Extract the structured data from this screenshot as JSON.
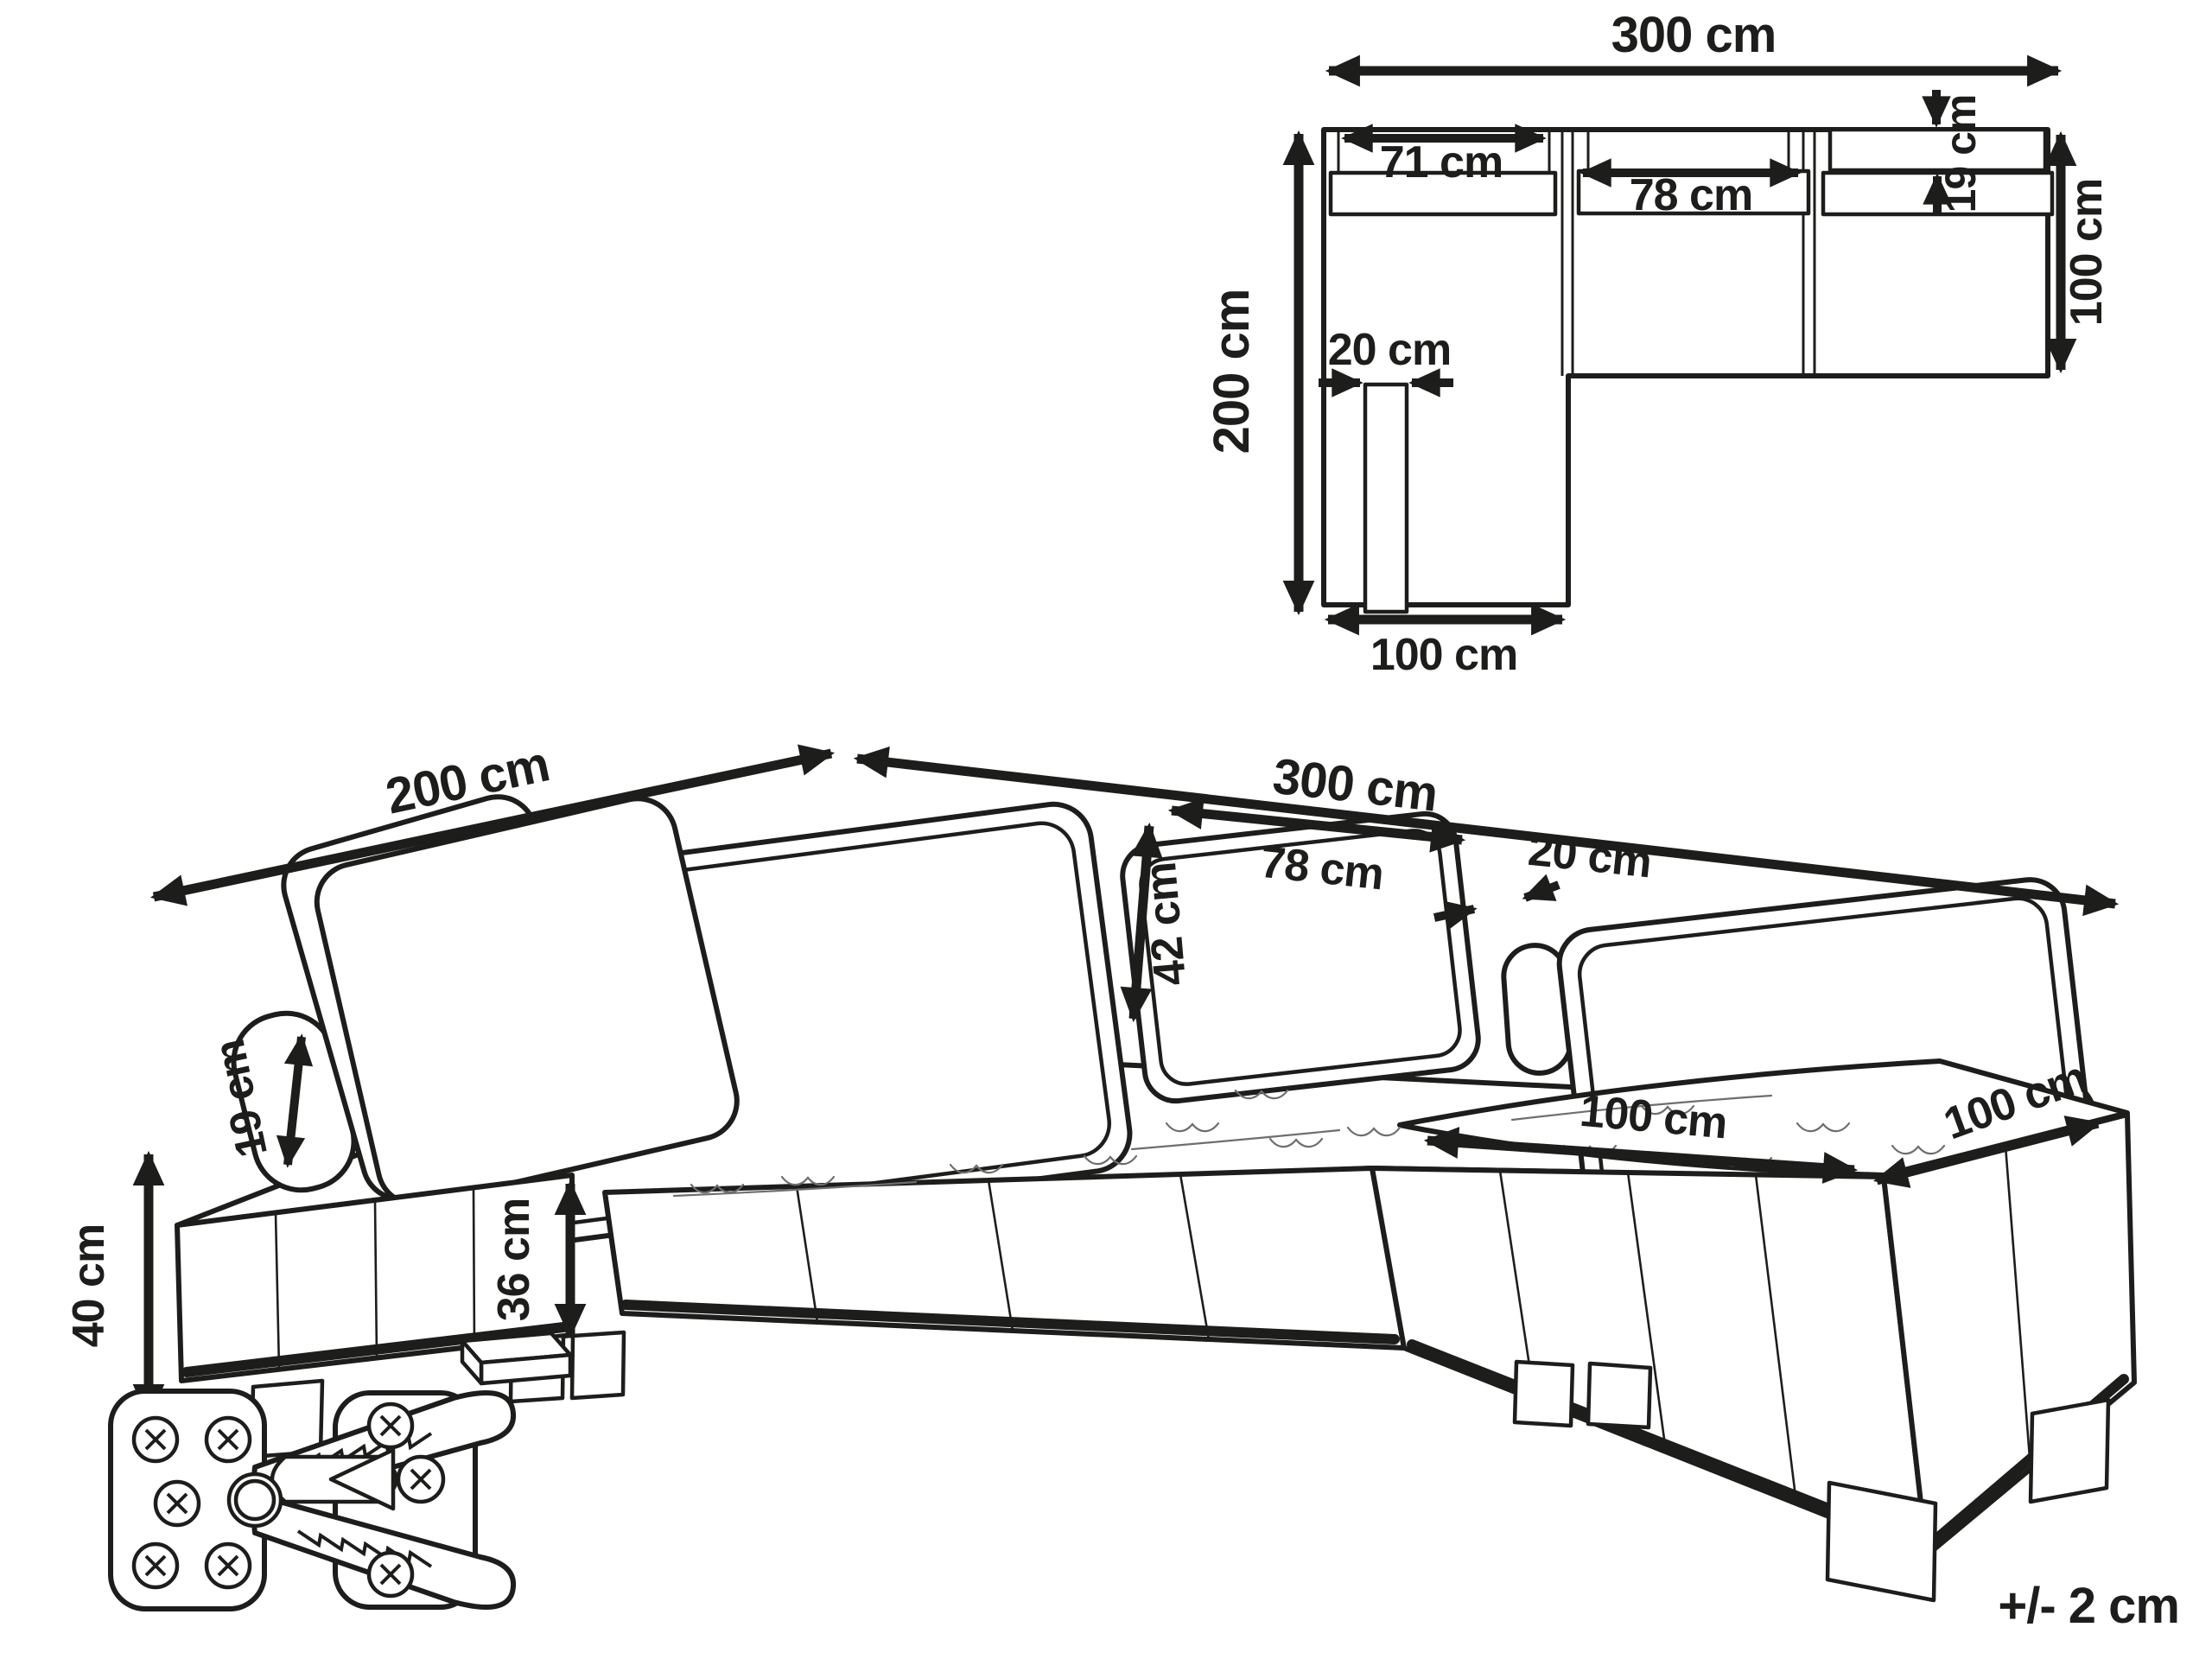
{
  "diagram_type": "modular-corner-sofa-dimension-diagram",
  "units": "cm",
  "style": {
    "ink": "#1d1d1b",
    "background": "#ffffff"
  },
  "plan_view": {
    "total_width": "300 cm",
    "total_depth": "200 cm",
    "left_back_cushion_width": "71 cm",
    "middle_back_cushion_width": "78 cm",
    "back_cushion_depth": "19 cm",
    "module_depth": "100 cm",
    "chaise_back_cushion_thickness": "20 cm",
    "chaise_width": "100 cm"
  },
  "perspective_view": {
    "chaise_length": "200 cm",
    "total_length": "300 cm",
    "bolster_diameter": "19 cm",
    "back_cushion_width": "78 cm",
    "back_cushion_height": "42 cm",
    "back_cushion_thickness": "20 cm",
    "seat_height": "40 cm",
    "base_height": "36 cm",
    "seat_cushion_width": "100 cm",
    "seat_cushion_depth": "100 cm"
  },
  "hardware": {
    "part": "module-connector-clip"
  },
  "note": {
    "tolerance": "+/- 2 cm"
  }
}
